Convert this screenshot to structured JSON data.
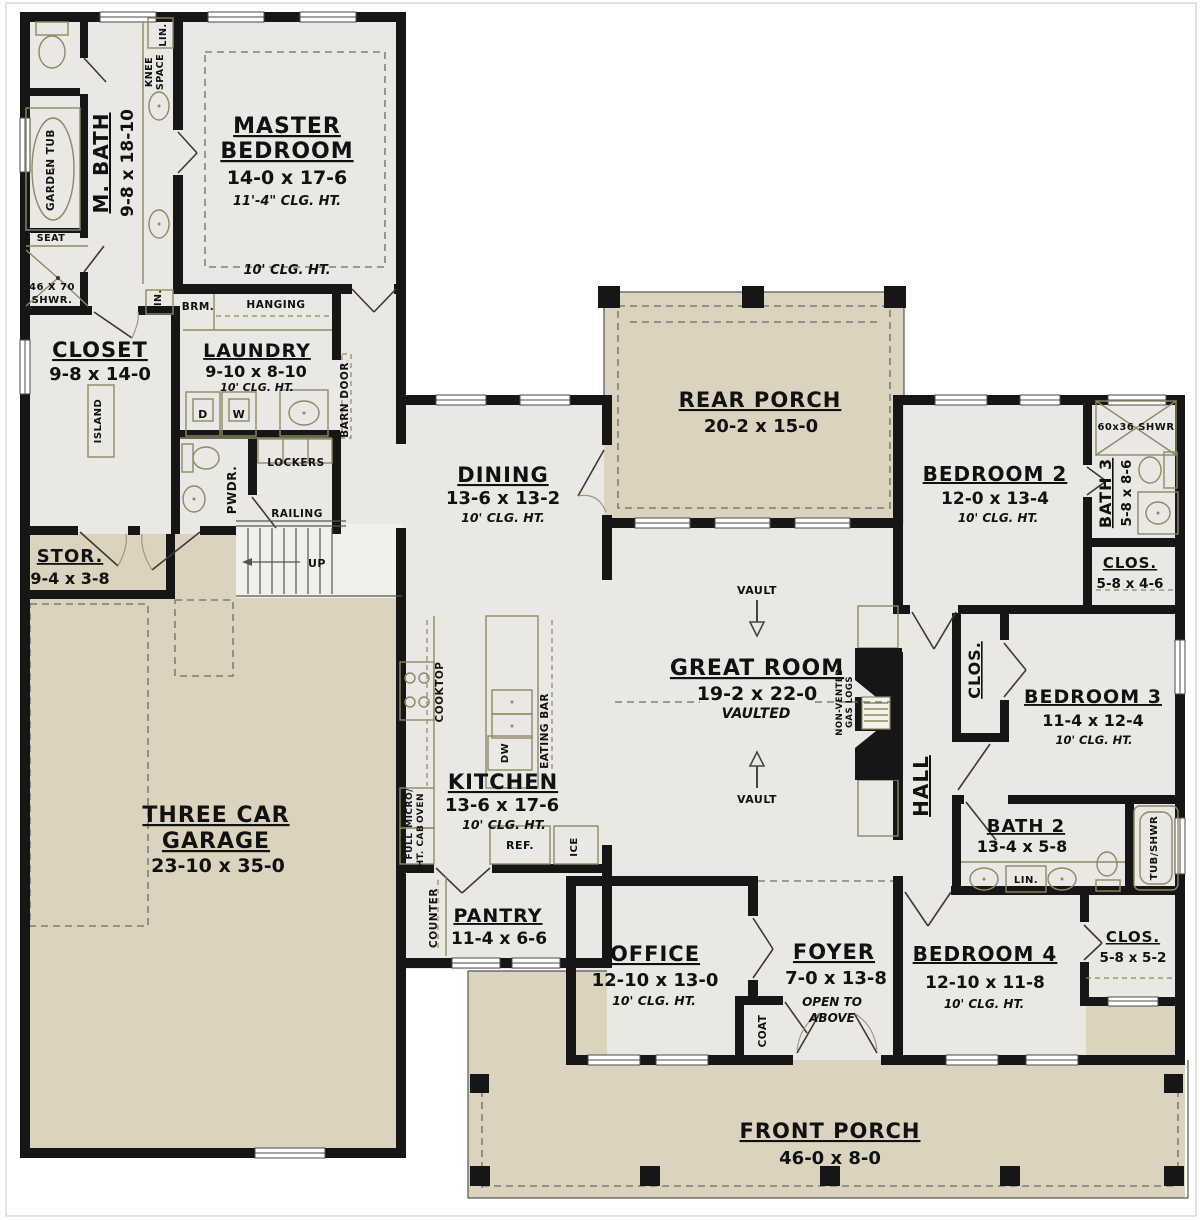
{
  "colors": {
    "wall": "#161616",
    "interior": "#e9e8e4",
    "porch": "#dcd3bf",
    "stairs": "#f1f0ec",
    "fixture": "#8e8963",
    "text": "#111111"
  },
  "rooms": {
    "master_bedroom": {
      "name1": "MASTER",
      "name2": "BEDROOM",
      "dims": "14-0 x 17-6",
      "note": "11'-4\" CLG. HT.",
      "note2": "10' CLG. HT."
    },
    "m_bath": {
      "name": "M. BATH",
      "dims": "9-8 x 18-10"
    },
    "closet": {
      "name": "CLOSET",
      "dims": "9-8 x 14-0"
    },
    "laundry": {
      "name": "LAUNDRY",
      "dims": "9-10 x 8-10",
      "note": "10' CLG. HT."
    },
    "stor": {
      "name": "STOR.",
      "dims": "9-4 x 3-8"
    },
    "garage": {
      "name1": "THREE CAR",
      "name2": "GARAGE",
      "dims": "23-10 x 35-0"
    },
    "dining": {
      "name": "DINING",
      "dims": "13-6 x 13-2",
      "note": "10' CLG. HT."
    },
    "kitchen": {
      "name": "KITCHEN",
      "dims": "13-6 x 17-6",
      "note": "10' CLG. HT."
    },
    "pantry": {
      "name": "PANTRY",
      "dims": "11-4 x 6-6"
    },
    "rear_porch": {
      "name": "REAR PORCH",
      "dims": "20-2 x 15-0"
    },
    "great_room": {
      "name": "GREAT ROOM",
      "dims": "19-2 x 22-0",
      "note": "VAULTED"
    },
    "bedroom2": {
      "name": "BEDROOM 2",
      "dims": "12-0 x 13-4",
      "note": "10' CLG. HT."
    },
    "bath3": {
      "name": "BATH 3",
      "dims": "5-8 x 8-6"
    },
    "clos_bath3": {
      "name": "CLOS.",
      "dims": "5-8 x 4-6"
    },
    "bedroom3": {
      "name": "BEDROOM 3",
      "dims": "11-4 x 12-4",
      "note": "10' CLG. HT."
    },
    "clos_bed3": {
      "name": "CLOS."
    },
    "hall": {
      "name": "HALL"
    },
    "bath2": {
      "name": "BATH 2",
      "dims": "13-4 x 5-8"
    },
    "bedroom4": {
      "name": "BEDROOM 4",
      "dims": "12-10 x 11-8",
      "note": "10' CLG. HT."
    },
    "clos_bed4": {
      "name": "CLOS.",
      "dims": "5-8 x 5-2"
    },
    "office": {
      "name": "OFFICE",
      "dims": "12-10 x 13-0",
      "note": "10' CLG. HT."
    },
    "foyer": {
      "name": "FOYER",
      "dims": "7-0 x 13-8",
      "note1": "OPEN TO",
      "note2": "ABOVE"
    },
    "front_porch": {
      "name": "FRONT PORCH",
      "dims": "46-0 x 8-0"
    }
  },
  "fixtures": {
    "garden_tub": "GARDEN TUB",
    "seat": "SEAT",
    "shwr46a": "46 X 70",
    "shwr46b": "SHWR.",
    "knee1": "KNEE",
    "knee2": "SPACE",
    "lin": "LIN.",
    "brm": "BRM.",
    "hanging": "HANGING",
    "barn_door": "BARN DOOR",
    "d": "D",
    "w": "W",
    "lockers": "LOCKERS",
    "pwdr": "PWDR.",
    "railing": "RAILING",
    "up": "UP",
    "island": "ISLAND",
    "cooktop": "COOKTOP",
    "eating_bar": "EATING BAR",
    "dw": "DW",
    "micro1": "MICRO/",
    "micro2": "OVEN",
    "cab1": "FULL",
    "cab2": "HT. CAB",
    "ref": "REF.",
    "ice": "ICE",
    "counter": "COUNTER",
    "vault": "VAULT",
    "gas1": "NON-VENTED",
    "gas2": "GAS LOGS",
    "shwr60": "60x36 SHWR",
    "tub_shwr": "TUB/SHWR",
    "coat": "COAT"
  }
}
